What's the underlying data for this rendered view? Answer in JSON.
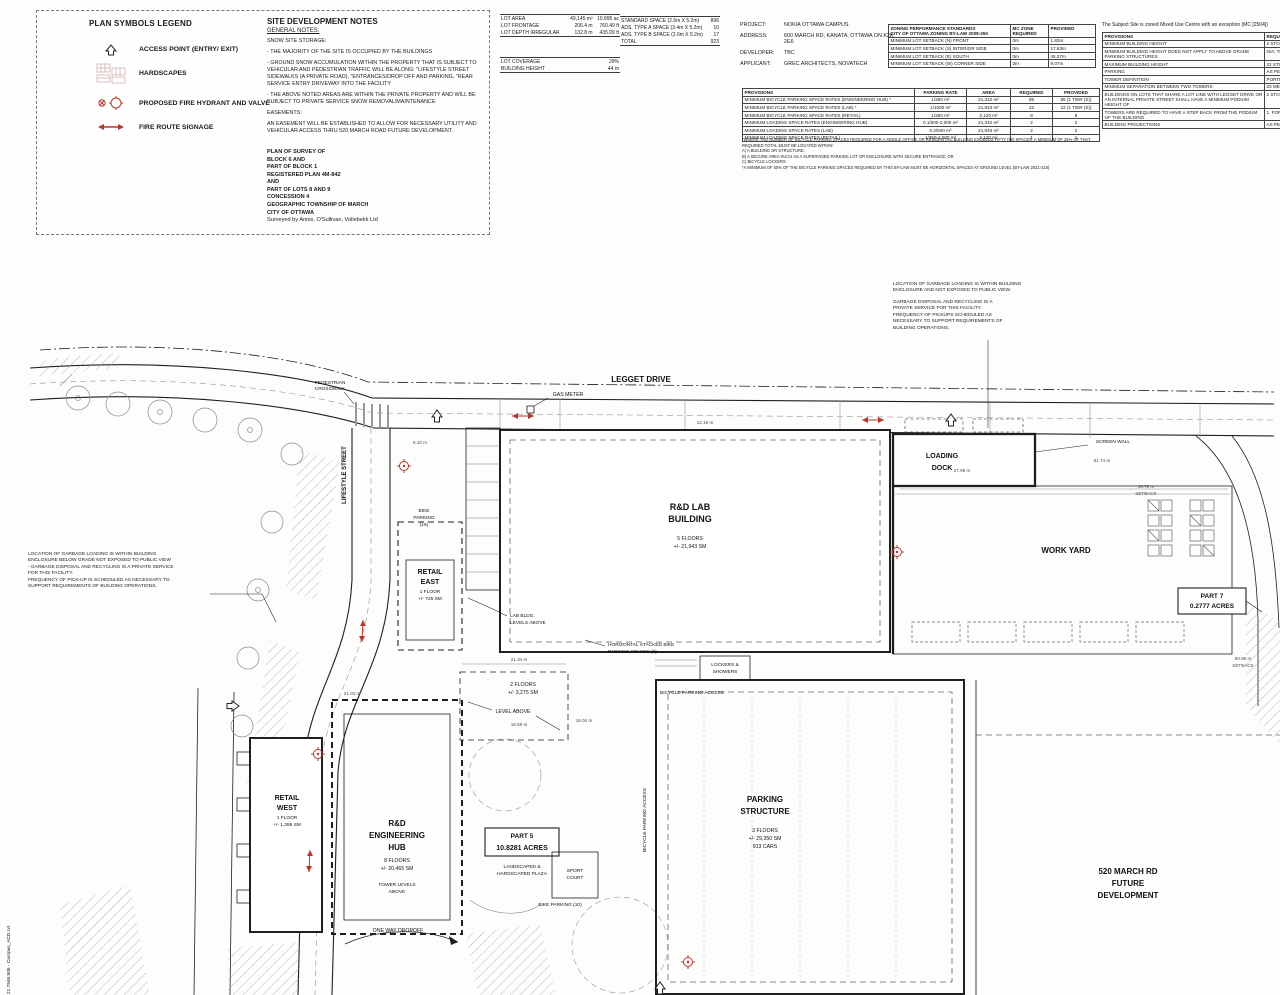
{
  "legend": {
    "title": "PLAN SYMBOLS LEGEND",
    "items": [
      {
        "icon": "access-point-arrow-icon",
        "label": "ACCESS POINT (ENTRY/ EXIT)"
      },
      {
        "icon": "hardscape-grid-icon",
        "label": "HARDSCAPES"
      },
      {
        "icon": "fire-hydrant-icon",
        "label": "PROPOSED FIRE HYDRANT AND VALVE"
      },
      {
        "icon": "fire-route-arrow-icon",
        "label": "FIRE ROUTE SIGNAGE"
      }
    ]
  },
  "notes": {
    "title": "SITE DEVELOPMENT NOTES",
    "subtitle": "GENERAL NOTES:",
    "lines": [
      "SNOW SITE STORAGE:",
      "- THE MAJORITY OF THE SITE IS OCCUPIED BY THE BUILDINGS",
      "- GROUND SNOW ACCUMULATION WITHIN THE PROPERTY THAT IS SUBJECT TO VEHICULAR AND PEDESTRIAN TRAFFIC WILL BE ALONG:  \"LIFESTYLE STREET SIDEWALKS (A PRIVATE ROAD),  \"ENTRANCES/DROP OFF AND PARKING,  \"REAR SERVICE ENTRY DRIVEWAY INTO THE FACILITY",
      "- THE ABOVE NOTED AREAS ARE WITHIN THE PRIVATE PROPERTY AND WILL BE SUBJECT TO PRIVATE SERVICE SNOW REMOVAL/MAINTENANCE",
      "EASEMENTS:",
      "AN EASEMENT WILL BE ESTABLISHED TO ALLOW FOR NECESSARY UTILITY AND VEHICULAR ACCESS THRU 520 MARCH ROAD FUTURE DEVELOPMENT."
    ],
    "survey": [
      "PLAN OF SURVEY OF",
      "BLOCK 6 AND",
      "PART OF BLOCK 1",
      "REGISTERED PLAN 4M-842",
      "AND",
      "PART OF LOTS 8 AND 9",
      "CONCESSION 4",
      "GEOGRAPHIC TOWNSHIP OF MARCH",
      "CITY OF OTTAWA",
      "Surveyed by Annis, O'Sullivan, Vollebekk Ltd"
    ]
  },
  "site_stats": {
    "rows": [
      [
        "LOT AREA",
        "49,145 m²",
        "10.895 ac"
      ],
      [
        "LOT FRONTAGE",
        "206.4 m",
        "760.49 ft"
      ],
      [
        "LOT DEPTH IRREGULAR",
        "132.8 m",
        "435.09 ft"
      ]
    ]
  },
  "coverage": {
    "rows": [
      [
        "LOT COVERAGE",
        "29%"
      ],
      [
        "BUILDING HEIGHT",
        "44 m"
      ]
    ]
  },
  "parking_spaces": {
    "rows": [
      [
        "STANDARD SPACE (2.6m X 5.2m)",
        "896"
      ],
      [
        "ADS. TYPE A SPACE (3.4m X 5.2m)",
        "10"
      ],
      [
        "ADS. TYPE B SPACE (2.6m X 5.2m)",
        "17"
      ],
      [
        "TOTAL",
        "923"
      ]
    ]
  },
  "project": {
    "rows": [
      [
        "PROJECT:",
        "NOKIA OTTAWA CAMPUS"
      ],
      [
        "ADDRESS:",
        "600 MARCH RD, KANATA, OTTAWA ON K2K 2E6"
      ],
      [
        "DEVELOPER:",
        "TBC"
      ],
      [
        "APPLICANT:",
        "GREC ARCHITECTS, NOVATECH"
      ]
    ]
  },
  "zoning": {
    "h1": "ZONING PERFORMANCE STANDARDS",
    "h2": "CITY OF OTTAWA ZONING BY-LAW 2008-250",
    "c1": "MC ZONE REQUIRED",
    "c2": "PROVIDED",
    "rows": [
      [
        "MINIMUM LOT SETBACK (N) FRONT",
        "0m",
        "1.83m"
      ],
      [
        "MINIMUM LOT SETBACK (S) INTERIOR SIDE",
        "0m",
        "17.63m"
      ],
      [
        "MINIMUM LOT SETBACK (E) SOUTH",
        "0m",
        "45.37m"
      ],
      [
        "MINIMUM LOT SETBACK (W) CORNER SIDE",
        "3m",
        "9.07m"
      ]
    ]
  },
  "provisions": {
    "headers": [
      "PROVISIONS",
      "PARKING RATE",
      "AREA",
      "REQUIRED",
      "PROVIDED"
    ],
    "rows": [
      [
        "MINIMUM BICYCLE PARKING SPACE RATES (ENGINEERING HUB) *",
        "1/250 m²",
        "21,342 m²",
        "85",
        "85 (1 TIER (S))"
      ],
      [
        "MINIMUM BICYCLE PARKING SPACE RATES (LAB) *",
        "1/1000 m²",
        "21,943 m²",
        "22",
        "22 (1 TIER (S))"
      ],
      [
        "MINIMUM BICYCLE PARKING SPACE RATES (RETAIL)",
        "1/250 m²",
        "2,120 m²",
        "8",
        "8"
      ],
      [
        "MINIMUM LOADING SPACE RATES (ENGINEERING HUB)",
        "0.1/500-2,000 m²",
        "21,342 m²",
        "2",
        "2"
      ],
      [
        "MINIMUM LOADING SPACE RATES (LAB)",
        "0.2/500 m²",
        "21,943 m²",
        "2",
        "2"
      ],
      [
        "MINIMUM LOADING SPACE RATES (RETAIL)",
        "1/350-2,000 m²",
        "2,120 m²",
        "1",
        "1"
      ]
    ],
    "footnotes": [
      "*WHERE THE NUMBER OF BICYCLE PARKING SPACES REQUIRED FOR A SINGLE OFFICE OR RESIDENTIAL BUILDING EXCEEDS FIFTY (50) SPACES, A MINIMUM OF 25% OF THAT REQUIRED TOTAL MUST BE LOCATED WITHIN:",
      "A)  A BUILDING OR STRUCTURE;",
      "B)  A SECURE AREA SUCH AS A SUPERVISED PARKING LOT OR ENCLOSURE WITH SECURE ENTRANCE; OR",
      "C)  BICYCLE LOCKERS",
      "*A MINIMUM OF 50% OF THE BICYCLE PARKING SPACES REQUIRED BY THIS BY-LAW MUST BE HORIZONTAL SPACES AT GROUND LEVEL (BY-LAW 2021-218)"
    ]
  },
  "mc_panel": {
    "intro": "The Subject Site is zoned Mixed Use Centre with an exception (MC [2504])",
    "c1": "PROVISIONS",
    "c2": "REQUIRED",
    "rows": [
      [
        "MINIMUM BUILDING HEIGHT",
        "2 STOREYS"
      ],
      [
        "MINIMUM BUILDING HEIGHT DOES NOT APPLY TO ABOVE GRADE PARKING STRUCTURES",
        "N/A, THE PARKING"
      ],
      [
        "MAXIMUM BUILDING HEIGHT",
        "22 STOREYS"
      ],
      [
        "PARKING",
        "AS PER BY-LAW"
      ],
      [
        "TOWER DEFINITION",
        "PORTION OF BUILDING"
      ],
      [
        "MINIMUM SEPARATION BETWEEN TWO TOWERS",
        "23 METRES"
      ],
      [
        "BUILDINGS ON LOTS THAT SHARE A LOT LINE WITH LEGGET DRIVE OR AN INTERNAL PRIVATE STREET SHALL HAVE A MINIMUM PODIUM HEIGHT OF",
        "2 STOREYS"
      ],
      [
        "TOWERS ARE REQUIRED TO HAVE A STEP BACK FROM THE PODIUM OF THE BUILDING",
        "1. FOR A HIGH-RISE  2. IN ALL"
      ],
      [
        "BUILDING PROJECTIONS",
        "AS PER SECTION"
      ]
    ]
  },
  "g_right": {
    "p1": [
      "LOCATION OF GARBAGE LOADING IS WITHIN BUILDING",
      "ENCLOSURE AND NOT EXPOSED TO PUBLIC VIEW."
    ],
    "p2": [
      "GARBAGE DISPOSAL AND RECYCLING IS A",
      "PRIVATE SERVICE FOR THIS FACILITY.",
      "FREQUENCY OF PICKUPS SCHEDULED AS",
      "NECESSARY TO SUPPORT REQUIREMENTS OF",
      "BUILDING OPERATIONS."
    ]
  },
  "g_left": {
    "p1": [
      "LOCATION OF GARBAGE LOADING IS WITHIN BUILDING",
      "ENCLOSURE BELOW GRADE NOT EXPOSED TO PUBLIC VIEW",
      "- GARBAGE DISPOSAL AND RECYCLING IS A PRIVATE SERVICE",
      "FOR THIS FACILITY.",
      "FREQUENCY OF PICK-UP IS SCHEDULED AS NECESSARY TO",
      "SUPPORT REQUIREMENTS OF BUILDING OPERATIONS."
    ]
  },
  "plan": {
    "legget_drive": "LEGGET DRIVE",
    "gas_meter": "GAS METER",
    "lifestyle_street": "LIFESTYLE STREET",
    "crosswalk": [
      "PEDESTRIAN",
      "CROSSWALK"
    ],
    "loading_dock": [
      "LOADING",
      "DOCK"
    ],
    "screen_wall": "SCREEN WALL",
    "rd_lab": [
      "R&D LAB",
      "BUILDING",
      "5 FLOORS",
      "+/- 21,943 SM"
    ],
    "work_yard": "WORK YARD",
    "part7": [
      "PART 7",
      "0.2777 ACRES"
    ],
    "retail_east": [
      "RETAIL",
      "EAST",
      "1 FLOOR",
      "+/- 725 SM"
    ],
    "bike16": [
      "BIKE",
      "PARKING",
      "(16)"
    ],
    "lab_levels": [
      "LAB BLDG.",
      "LEVELS ABOVE"
    ],
    "stacked": [
      "HORIZONTAL STACKED BIKE",
      "PARKING SPACES (8)"
    ],
    "lockers": [
      "LOCKERS &",
      "SHOWERS"
    ],
    "bpa": "BICYCLE PARKING ACCESS",
    "two_floors": [
      "2 FLOORS",
      "+/- 3,275 SM"
    ],
    "level_above": "LEVEL ABOVE",
    "retail_west": [
      "RETAIL",
      "WEST",
      "1 FLOOR",
      "+/- 1,395 SM"
    ],
    "hub": [
      "R&D",
      "ENGINEERING",
      "HUB",
      "8 FLOORS",
      "+/- 20,465 SM"
    ],
    "tower": [
      "TOWER LEVELS",
      "ABOVE"
    ],
    "part5": [
      "PART 5",
      "10.8281 ACRES"
    ],
    "plaza": [
      "LANDSCAPED &",
      "HARDSCAPED PLAZA"
    ],
    "sport": [
      "SPORT",
      "COURT"
    ],
    "bike10": "BIKE PARKING (10)",
    "pstruct": [
      "PARKING",
      "STRUCTURE",
      "3 FLOORS",
      "+/- 29,350 SM",
      "913 CARS"
    ],
    "future": [
      "520 MARCH RD",
      "FUTURE",
      "DEVELOPMENT"
    ],
    "one_way": "ONE WAY DROPOFF",
    "file_tag": "21.7946.906 - Campus_ACD.rvt",
    "dims": [
      "61.74 m",
      "45.72 m",
      "SETBACK",
      "27.98 m",
      "60.96 m",
      "SETBACK",
      "21.34 m",
      "16.04 m",
      "18.59 m",
      "21.03 m",
      "12.19 m",
      "6.10 m"
    ]
  },
  "colors": {
    "accent_red": "#b4382f",
    "line_dark": "#1f1f1f"
  }
}
